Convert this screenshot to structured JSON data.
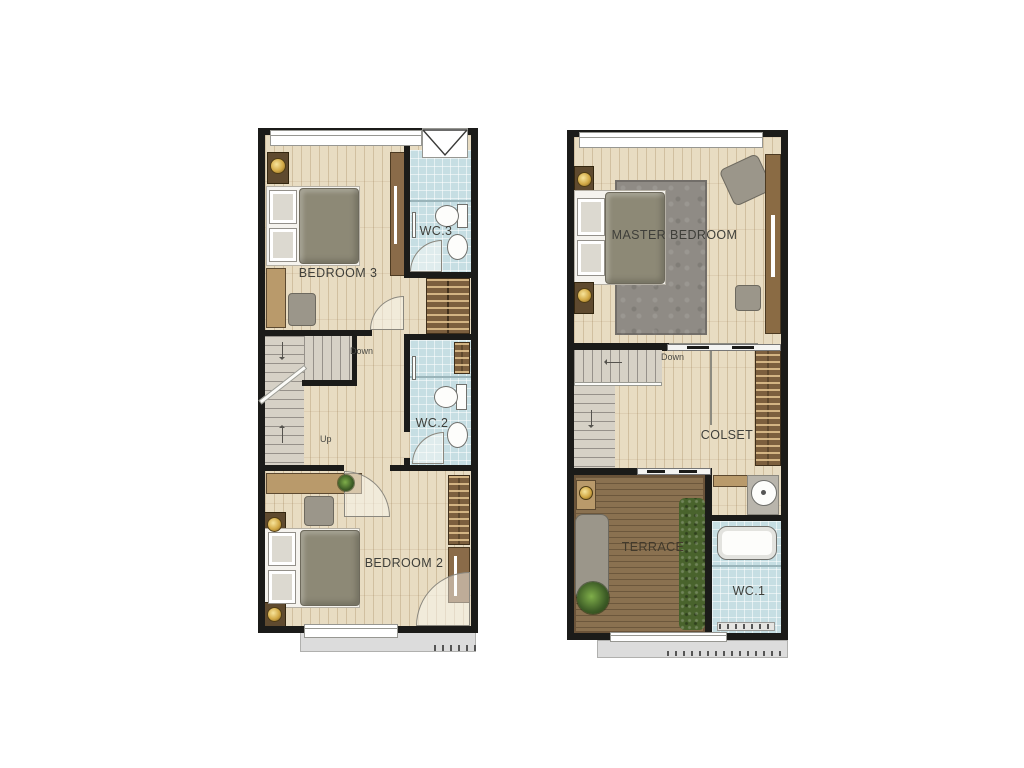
{
  "colors": {
    "wall": "#1b1b19",
    "wood": "#e8dcc2",
    "tile": "#c6dee3",
    "deck": "#8a7150",
    "stair": "#d6d1c6",
    "brown": "#7c5f3e",
    "brownDark": "#5f4a2f",
    "brownLight": "#b99a6b",
    "grayFurn": "#9b968a",
    "blanket": "#8d8976",
    "rug": "#8f8b85",
    "hedge": "#49632c",
    "balcony": "#dcdcdc",
    "label": "#3f3f3a"
  },
  "plans": {
    "left": {
      "rooms": {
        "bedroom3": {
          "label": "BEDROOM 3"
        },
        "wc3": {
          "label": "WC.3"
        },
        "wc2": {
          "label": "WC.2"
        },
        "bedroom2": {
          "label": "BEDROOM 2"
        }
      },
      "stairs": {
        "down": "Down",
        "up": "Up"
      }
    },
    "right": {
      "rooms": {
        "master": {
          "label": "MASTER BEDROOM"
        },
        "closet": {
          "label": "COLSET"
        },
        "terrace": {
          "label": "TERRACE"
        },
        "wc1": {
          "label": "WC.1"
        }
      },
      "stairs": {
        "down": "Down"
      }
    }
  }
}
